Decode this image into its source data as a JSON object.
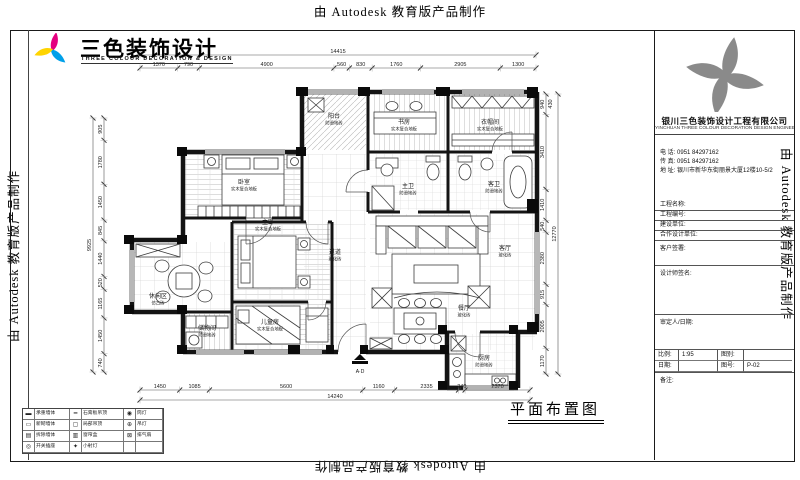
{
  "watermark": {
    "text": "由 Autodesk 教育版产品制作"
  },
  "logo": {
    "title": "三色装饰设计",
    "subtitle": "THREE COLOUR DECORATION & DESIGN"
  },
  "title_block": {
    "company": "银川三色装饰设计工程有限公司",
    "company_en": "YINCHUAN THREE COLOUR DECORATION DESIGN ENGINEERING CO.,LTD",
    "phone_label": "电 话:",
    "phone": "0951 84297162",
    "fax_label": "传 真:",
    "fax": "0951 84297162",
    "address_label": "地 址:",
    "address": "银川市新华东街丽景大厦12楼10-5/2",
    "fields": [
      {
        "label": "工程名称:",
        "value": ""
      },
      {
        "label": "工程编号:",
        "value": ""
      },
      {
        "label": "建设单位:",
        "value": ""
      },
      {
        "label": "合作设计单位:",
        "value": ""
      }
    ],
    "client_sign_label": "客户签署:",
    "designer_sign_label": "设计师签名:",
    "approver_label": "审定人/日期:",
    "scale_label": "比例:",
    "scale_value": "1:95",
    "type_label": "图别:",
    "type_value": "",
    "date_label": "日期:",
    "date_value": "",
    "sheet_label": "图号:",
    "sheet_value": "P-02",
    "remark_label": "备注:"
  },
  "plan": {
    "title": "平面布置图",
    "marker": "A·D",
    "rooms": [
      {
        "id": "bedroom",
        "name": "卧室",
        "material": "实木复合地板"
      },
      {
        "id": "study",
        "name": "书房",
        "material": "实木复合地板"
      },
      {
        "id": "cloak",
        "name": "衣帽间",
        "material": "实木复合地板"
      },
      {
        "id": "balcony",
        "name": "阳台",
        "material": "防滑地砖"
      },
      {
        "id": "bath_m",
        "name": "主卫",
        "material": "防滑地砖"
      },
      {
        "id": "bath_g",
        "name": "客卫",
        "material": "防滑地砖"
      },
      {
        "id": "hall",
        "name": "过道",
        "material": "玻化砖"
      },
      {
        "id": "master",
        "name": "主卧",
        "material": "实木复合地板"
      },
      {
        "id": "kids",
        "name": "儿童房",
        "material": "实木复合地板"
      },
      {
        "id": "storage",
        "name": "储物间",
        "material": "防滑地砖"
      },
      {
        "id": "nook",
        "name": "休闲区",
        "material": "仿古砖"
      },
      {
        "id": "living",
        "name": "客厅",
        "material": "玻化砖"
      },
      {
        "id": "dining",
        "name": "餐厅",
        "material": "玻化砖"
      },
      {
        "id": "kitchen",
        "name": "厨房",
        "material": "防滑地砖"
      }
    ],
    "dims": {
      "top": {
        "total": "14415",
        "segments": [
          "1370",
          "790",
          "4900",
          "560",
          "830",
          "1760",
          "2905",
          "1300"
        ]
      },
      "bottom": {
        "total": "14240",
        "segments": [
          "1450",
          "1085",
          "5600",
          "1160",
          "2335",
          "240",
          "2370"
        ]
      },
      "left": {
        "total": "9925",
        "segments": [
          "905",
          "1780",
          "1450",
          "845",
          "1440",
          "520",
          "1165",
          "1450",
          "740"
        ]
      },
      "right": {
        "total": "12770",
        "extra": "430",
        "segments": [
          "940",
          "3410",
          "1410",
          "540",
          "2380",
          "915",
          "2005",
          "1170"
        ]
      }
    }
  },
  "legend": {
    "rows": [
      [
        {
          "glyph": "▬",
          "label": "承重墙体"
        },
        {
          "glyph": "━",
          "label": "石膏板吊顶"
        },
        {
          "glyph": "◉",
          "label": "筒灯"
        }
      ],
      [
        {
          "glyph": "▭",
          "label": "新砌墙体"
        },
        {
          "glyph": "▢",
          "label": "局部吊顶"
        },
        {
          "glyph": "⊕",
          "label": "吊灯"
        }
      ],
      [
        {
          "glyph": "▤",
          "label": "拆除墙体"
        },
        {
          "glyph": "▥",
          "label": "窗帘盒"
        },
        {
          "glyph": "⊠",
          "label": "排气扇"
        }
      ],
      [
        {
          "glyph": "◎",
          "label": "开关插座"
        },
        {
          "glyph": "✦",
          "label": "小射灯"
        },
        {
          "glyph": "",
          "label": ""
        }
      ]
    ]
  },
  "colors": {
    "magenta": "#e4007f",
    "cyan": "#00a0e9",
    "yellow": "#ffd400",
    "gray_logo": "#8a8a8a"
  }
}
